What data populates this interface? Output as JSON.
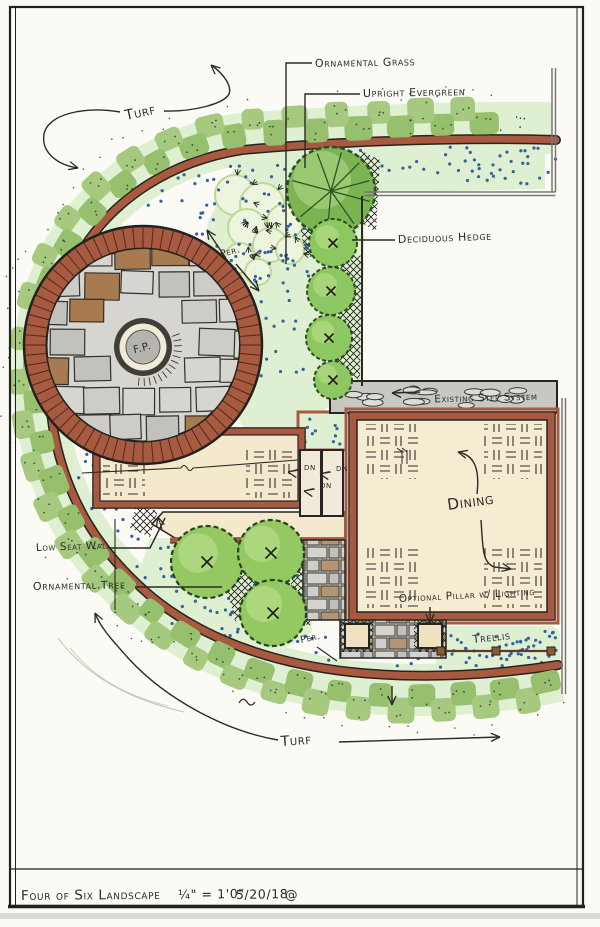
{
  "title_block": {
    "project": "Four of Six Landscape",
    "scale": "¼\" = 1'0\"",
    "date": "5/20/18",
    "mark": "@"
  },
  "labels": {
    "turf_top": "Turf",
    "turf_bottom": "Turf",
    "ornamental_grass": "Ornamental Grass",
    "upright_evergreen": "Upright Evergreen",
    "deciduous_hedge": "Deciduous Hedge",
    "existing_step_system": "Existing Step System",
    "dining": "Dining",
    "low_seat_wall": "Low Seat Wall",
    "ornamental_tree": "Ornamental Tree",
    "optional_pillar": "Optional Pillar w/ Lighting",
    "trellis": "Trellis",
    "perennials": "Per.",
    "fire_pit": "F.P.",
    "down": "DN"
  },
  "colors": {
    "paper": "#fbfaf4",
    "ink": "#2b2a26",
    "brick": "#a85a41",
    "brick_dark": "#4a2a1e",
    "hedge": "#a5c97e",
    "hedge_alt": "#96bf6e",
    "bed": "#dff0d2",
    "bed_blob": "#edf5df",
    "blob_edge": "#bcd996",
    "canopy": "#93c862",
    "canopy_light": "#c2e394",
    "evergreen": "#7cb454",
    "evergreen_dark": "#29501f",
    "stone": "#d6d5d0",
    "stone_dark": "#c6c4bf",
    "brown": "#a77a50",
    "tan": "#f4e8cd",
    "gray_band": "#c8c7c2",
    "blue_dot": "#33639e",
    "wall_gray": "#7a7772",
    "mulch_ink": "#1c1c1a"
  }
}
